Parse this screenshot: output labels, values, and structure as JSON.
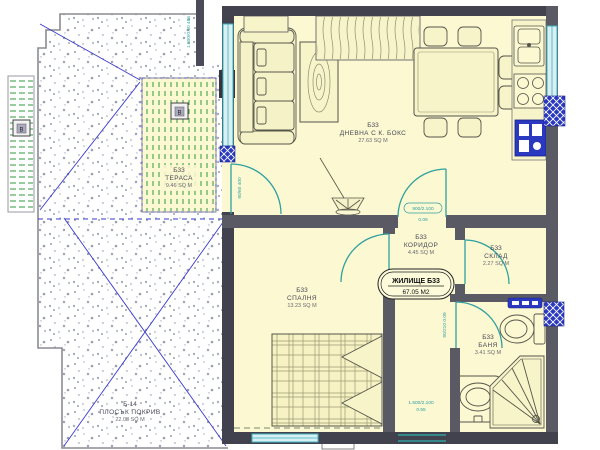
{
  "plan": {
    "rooms": {
      "living": {
        "code": "Б33",
        "name": "ДНЕВНА С К. БОКС",
        "area": "27.63 SQ M"
      },
      "terrace": {
        "code": "Б33",
        "name": "ТЕРАСА",
        "area": "9.46 SQ M"
      },
      "bedroom": {
        "code": "Б33",
        "name": "СПАЛНЯ",
        "area": "13.23 SQ M"
      },
      "corridor": {
        "code": "Б33",
        "name": "КОРИДОР",
        "area": "4.45 SQ M"
      },
      "storage": {
        "code": "Б33",
        "name": "СКЛАД",
        "area": "2.27 SQ M"
      },
      "bath": {
        "code": "Б33",
        "name": "БАНЯ",
        "area": "3.41 SQ M"
      },
      "roof": {
        "code": "Б-14",
        "name": "ПЛОСЪК ПОКРИВ",
        "area": "22.08 SQ M"
      }
    },
    "unit_label": {
      "name": "ЖИЛИЩЕ Б33",
      "area": "67.05 М2"
    },
    "markers": {
      "terrace_marker": "В",
      "roof_marker": "В"
    },
    "dimensions": {
      "top_left_window": "1.800/0.60 485",
      "terrace_door": "90/60 400",
      "corridor_door": "900/2.100",
      "corridor_door_sub": "0.09",
      "bath_door": "90/210 0.09",
      "entry_line1": "1.500/2.100",
      "entry_line2": "0.55"
    },
    "colors": {
      "floor": "#fbf8d2",
      "wall_exterior": "#42424e",
      "wall_interior": "#5a5a64",
      "door_teal": "#2fa0a0",
      "window_cyan": "#3fb0c0",
      "shaft_blue": "#2a39c0",
      "hatch_green": "#2f9a3f",
      "roof_line_blue": "#3a3acc"
    }
  }
}
